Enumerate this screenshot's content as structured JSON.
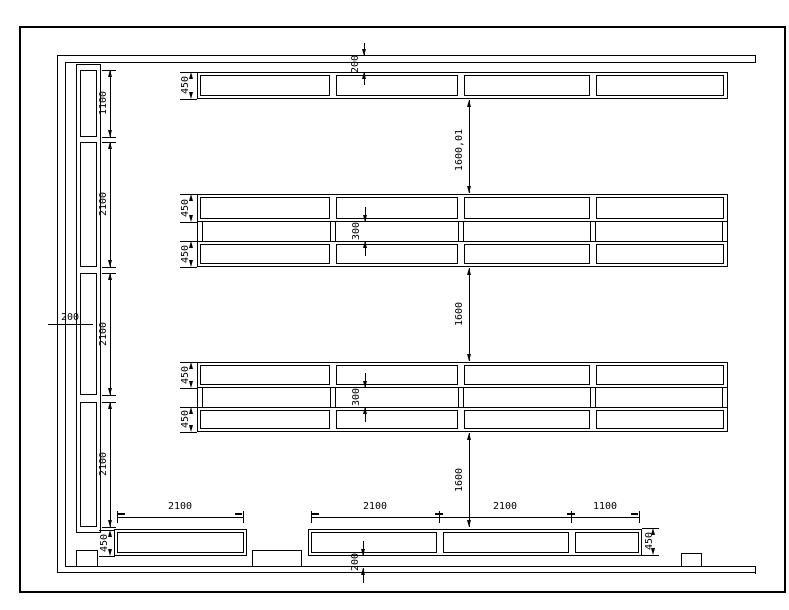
{
  "colors": {
    "line": "#000000",
    "background": "#ffffff"
  },
  "dims": {
    "top_clearance": "200",
    "left_clearance": "200",
    "bottom_clearance": "200",
    "aisle_1": "1600,01",
    "aisle_2": "1600",
    "aisle_3": "1600",
    "back_gap_row2": "300",
    "back_gap_row3": "300",
    "left_rack_sections": [
      "1100",
      "2100",
      "2100",
      "2100"
    ],
    "bottom_bays": [
      "2100",
      "2100",
      "2100",
      "1100"
    ],
    "rack_depths": {
      "row1": "450",
      "row2_front": "450",
      "row2_back": "450",
      "row3_front": "450",
      "row3_back": "450",
      "bottom_left": "450",
      "bottom_right": "450"
    }
  }
}
